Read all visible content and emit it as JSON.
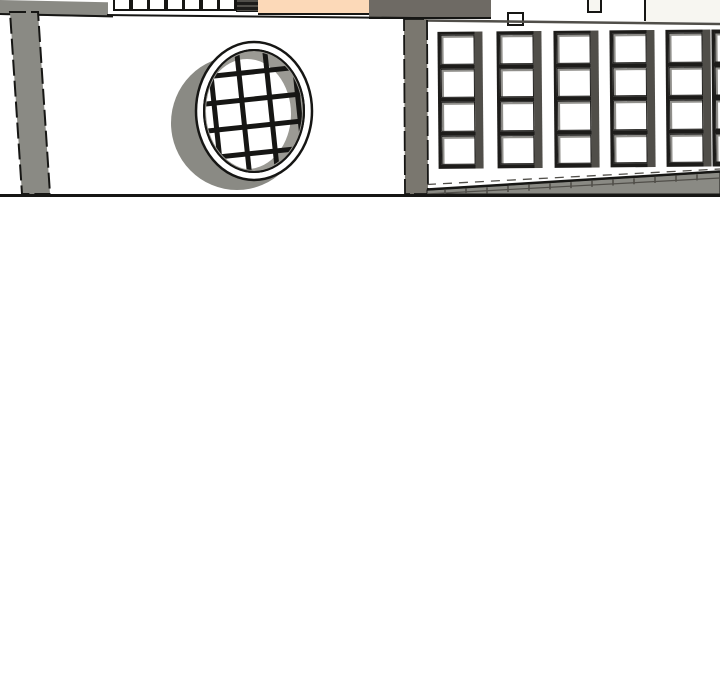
{
  "scene": {
    "kind": "3d-building-model-render",
    "empty_lower_area": true
  },
  "colors": {
    "background": "#ffffff",
    "wall_white": "#ffffff",
    "offwhite": "#f7f6f1",
    "concrete_gray": "#8a8a84",
    "pillar_gray": "#8a8a84",
    "pillar_gray_dark": "#7a776f",
    "dark_roof_gray": "#6e6a64",
    "peach_panel": "#fcd9b8",
    "edge_black": "#161614",
    "frame_dark": "#1d1c1a",
    "frame_shadow": "#504e49",
    "window_inner_gray": "#9b9a94",
    "ledge_gray": "#8a8a84"
  },
  "top_strip": {
    "small_square_count": 7,
    "louver_stripe_count": 2
  },
  "circle_window": {
    "vertical_bar_count": 4,
    "horizontal_bar_count": 4
  },
  "right_facade": {
    "window_column_count": 6,
    "panes_per_column": 4
  },
  "ledge": {
    "plank_tick_count": 13
  }
}
